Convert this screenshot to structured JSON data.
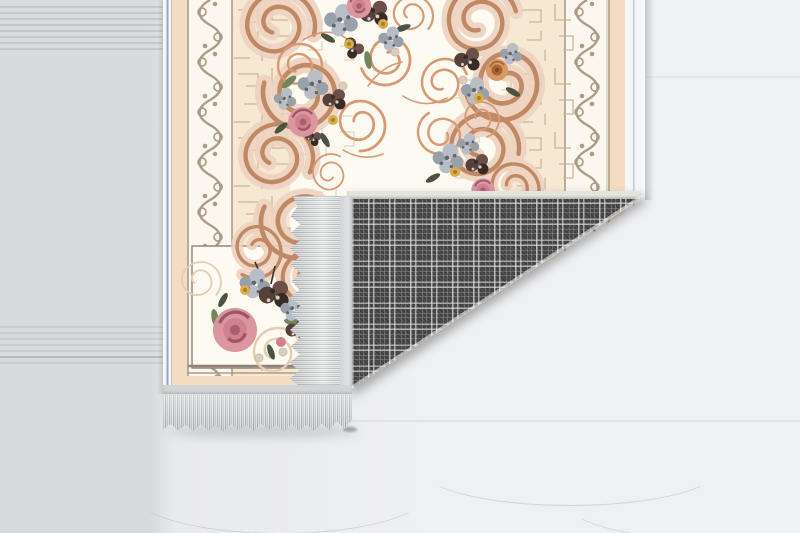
{
  "scene": {
    "description": "Product photograph of a decorative rectangular area rug lying on a whitewashed gray wooden floor. The rug front shows an ivory and cream baroque design with pink roses, plum and slate flower bouquets, yellow accents and copper scrollwork inside layered ornamental borders. The bottom-right corner of the rug is folded up and over, revealing a dark gray windowpane-plaid woven backing. Light gray fringe tassels run along the rug's bottom edge and along the folded-over edge.",
    "text_content": "none",
    "objects": [
      {
        "name": "wood-floor",
        "detail": "pale gray-white wooden planks, horizontal grain, subtle seams and a small knot"
      },
      {
        "name": "rug-front",
        "detail": "ivory field, floral bouquets, copper spiral scrolls, blush baroque scroll chains, crackle line texture, white scroll border bands, peach margins, white edge binding with blue line"
      },
      {
        "name": "rug-back-plaid",
        "detail": "charcoal gray fabric with white double-line windowpane plaid, folded triangular corner"
      },
      {
        "name": "fringe",
        "detail": "silver-gray tassel fringe on bottom edge and on folded edge"
      }
    ],
    "fold": {
      "crease_from_xy": [
        347,
        390
      ],
      "crease_to_xy": [
        645,
        197
      ],
      "plaid_triangle": [
        [
          347,
          197
        ],
        [
          645,
          197
        ],
        [
          347,
          390
        ]
      ]
    }
  },
  "colors": {
    "floor-base": "#e9eaec",
    "floor-left": "#d9dadc",
    "floor-light": "#eff0f2",
    "rug-cream": "#f6e8d2",
    "rug-peach": "#f2ddc2",
    "rug-ivory": "#fdfaf1",
    "band-white": "#fbf7ee",
    "band-line": "#ab9c89",
    "frame-line": "#8e8374",
    "crackle": "#c9b697",
    "blush-fill": "#eed2bf",
    "blush-line": "#c08966",
    "blush-pale": "#e3cdb4",
    "copper": "#d79a72",
    "rose-pink": "#dc96a0",
    "rose-mid": "#cf8190",
    "rose-deep": "#a85f6e",
    "rose-stroke": "#9e5664",
    "rose-orange": "#d89a64",
    "rose-orange-deep": "#aa6334",
    "plum": "#55403c",
    "plum-light": "#6b4f48",
    "plum-dark": "#382a26",
    "speck-light": "#d8cfc4",
    "slate": "#98a0aa",
    "slate-light": "#b8bec6",
    "slate-dark": "#5c636d",
    "accent-yellow": "#d9ad49",
    "yellow-deep": "#a67f2a",
    "leaf": "#74855c",
    "leaf-dark": "#4a5340",
    "binding-white": "#f4f6f7",
    "binding-blue": "#93a7c0",
    "fringe-hi": "#eceded",
    "fringe-hi2": "#dfe1e1",
    "fringe-mid": "#c2c5c6",
    "fringe-low": "#a9adae",
    "fringe-header": "#d2d5d6",
    "plaid-base": "#454545",
    "plaid-edge": "#e5e3de"
  }
}
